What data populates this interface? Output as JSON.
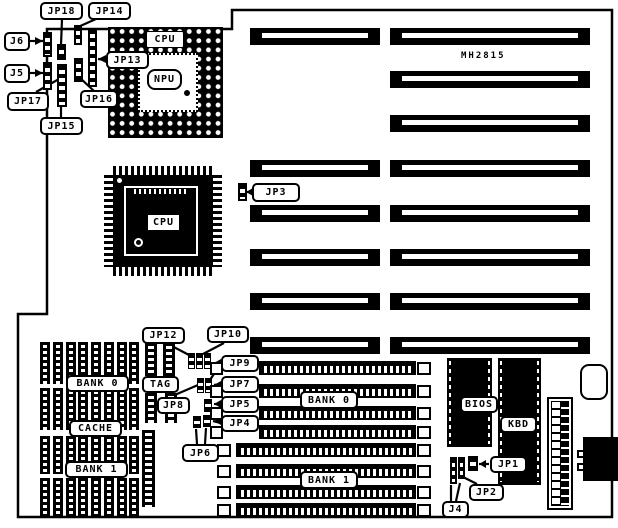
{
  "colors": {
    "ink": "#000000",
    "paper": "#ffffff"
  },
  "board": {
    "model": "MH2815"
  },
  "labels": {
    "jp18": "JP18",
    "jp14": "JP14",
    "j6": "J6",
    "j5": "J5",
    "jp17": "JP17",
    "jp15": "JP15",
    "jp16": "JP16",
    "jp13": "JP13",
    "cpu_socket": "CPU",
    "npu": "NPU",
    "cpu_chip": "CPU",
    "jp3": "JP3",
    "jp12": "JP12",
    "jp10": "JP10",
    "jp9": "JP9",
    "jp7": "JP7",
    "jp5": "JP5",
    "jp4": "JP4",
    "jp8": "JP8",
    "jp6": "JP6",
    "tag": "TAG",
    "bank0_cache": "BANK 0",
    "cache": "CACHE",
    "bank1_cache": "BANK 1",
    "bank0_simm": "BANK 0",
    "bank1_simm": "BANK 1",
    "bios": "BIOS",
    "kbd": "KBD",
    "jp1": "JP1",
    "jp2": "JP2",
    "j4": "J4"
  }
}
